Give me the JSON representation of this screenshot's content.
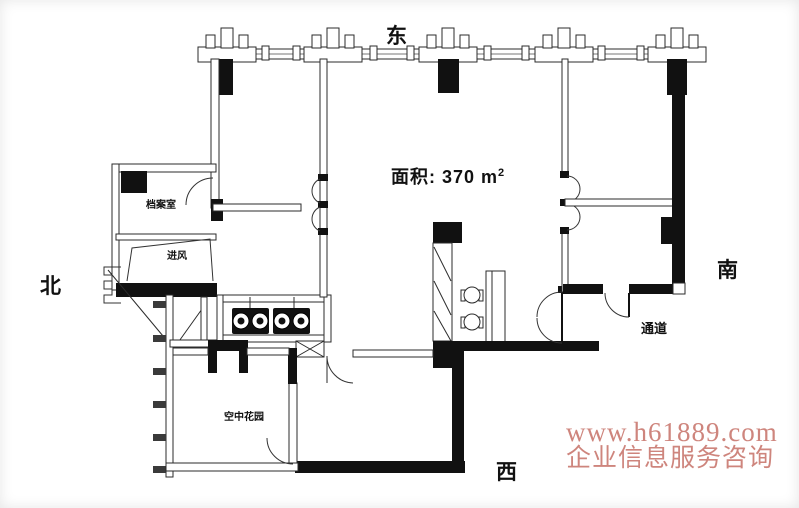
{
  "plan": {
    "title": "户型平面图",
    "area_text": "面积: 370 m",
    "area_sup": "2",
    "compass": {
      "east": "东",
      "south": "南",
      "west": "西",
      "north": "北"
    },
    "rooms": {
      "archive": "档案室",
      "air_inlet": "进风",
      "sky_garden": "空中花园",
      "corridor": "通道"
    },
    "watermark": {
      "line1": "www.h61889.com",
      "line2": "企业信息服务咨询",
      "color": "#c57066"
    },
    "colors": {
      "wall_black": "#111111",
      "wall_line": "#2b2b2b",
      "background": "#ffffff"
    }
  }
}
